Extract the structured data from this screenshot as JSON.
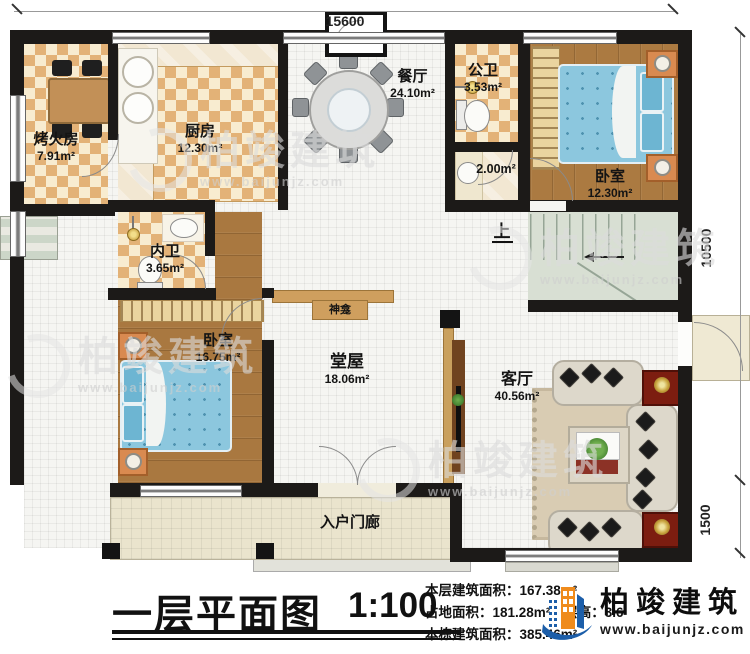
{
  "plan_type": "architectural-floor-plan",
  "dimensions": {
    "top_width": "15600",
    "right_upper_height": "10500",
    "right_lower_height": "1500"
  },
  "rooms": {
    "kaohuofang": {
      "name": "烤火房",
      "area": "7.91m²"
    },
    "kitchen": {
      "name": "厨房",
      "area": "12.30m²"
    },
    "dining": {
      "name": "餐厅",
      "area": "24.10m²"
    },
    "public_bath": {
      "name": "公卫",
      "area": "3.53m²"
    },
    "wash_area": {
      "area": "2.00m²"
    },
    "bedroom_ne": {
      "name": "卧室",
      "area": "12.30m²"
    },
    "inner_bath": {
      "name": "内卫",
      "area": "3.65m²"
    },
    "bedroom_w": {
      "name": "卧室",
      "area": "16.75m²"
    },
    "hall": {
      "name": "堂屋",
      "area": "18.06m²"
    },
    "living": {
      "name": "客厅",
      "area": "40.56m²"
    },
    "shrine": {
      "name": "神龛"
    },
    "porch": {
      "name": "入户门廊"
    },
    "stairs": {
      "up_label": "上"
    }
  },
  "titleblock": {
    "title": "一层平面图",
    "scale": "1:100",
    "stats": {
      "line1_label": "本层建筑面积：",
      "line1_value": "167.38m²",
      "line2a_label": "占地面积：",
      "line2a_value": "181.28m²",
      "line2b_label": "层高：",
      "line2b_value": "3.6",
      "line3_label": "本栋建筑面积：",
      "line3_value": "385.46m²"
    }
  },
  "brand": {
    "name": "柏竣建筑",
    "url": "www.baijunjz.com"
  },
  "watermark": {
    "name": "柏竣建筑",
    "url": "www.baijunjz.com"
  },
  "colors": {
    "wall": "#1c1a18",
    "checker_tan": "#e3b277",
    "wood": "#ab7a41",
    "bed_blue": "#8cc7de",
    "logo_blue": "#1c5ea9",
    "logo_orange": "#ef8b1c",
    "accent_red_table": "#7c1d10"
  }
}
